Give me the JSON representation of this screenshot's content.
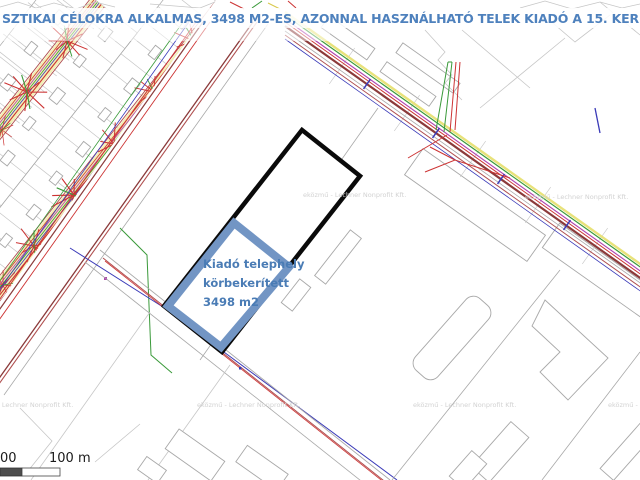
{
  "page": {
    "title": "SZTIKAI CÉLOKRA ALKALMAS, 3498 M2-ES, AZONNAL HASZNÁLHATÓ TELEK KIADÓ A 15. KERÜL"
  },
  "map": {
    "type": "cadastral-utility-map",
    "highlighted_parcel": {
      "label_line1": "Kiadó telephely",
      "label_line2": "körbekerített",
      "label_line3": "3498 m2",
      "area_m2": 3498
    },
    "watermark_text": "eközmű - Lechner Nonprofit Kft.",
    "scalebar": {
      "left_label": "00",
      "right_label": "100 m"
    }
  },
  "colors": {
    "title_blue": "#4e81bd",
    "label_blue": "#4a7cb5",
    "parcel_border_blue": "#7295c4",
    "parcel_outline_black": "#0a0a0a",
    "street_yellow": "#f3edad",
    "util_red": "#cc3333",
    "util_green": "#3a9a3a",
    "util_blue": "#3a3ab8",
    "util_magenta": "#b040b0",
    "road_maroon": "#8b3a3a",
    "road_red": "#b05050",
    "gray_line": "#a8a8a8",
    "gray_soft": "#c6c6c6",
    "watermark_gray": "#d2d2d2",
    "scalebar_dark": "#4d4d4d"
  }
}
